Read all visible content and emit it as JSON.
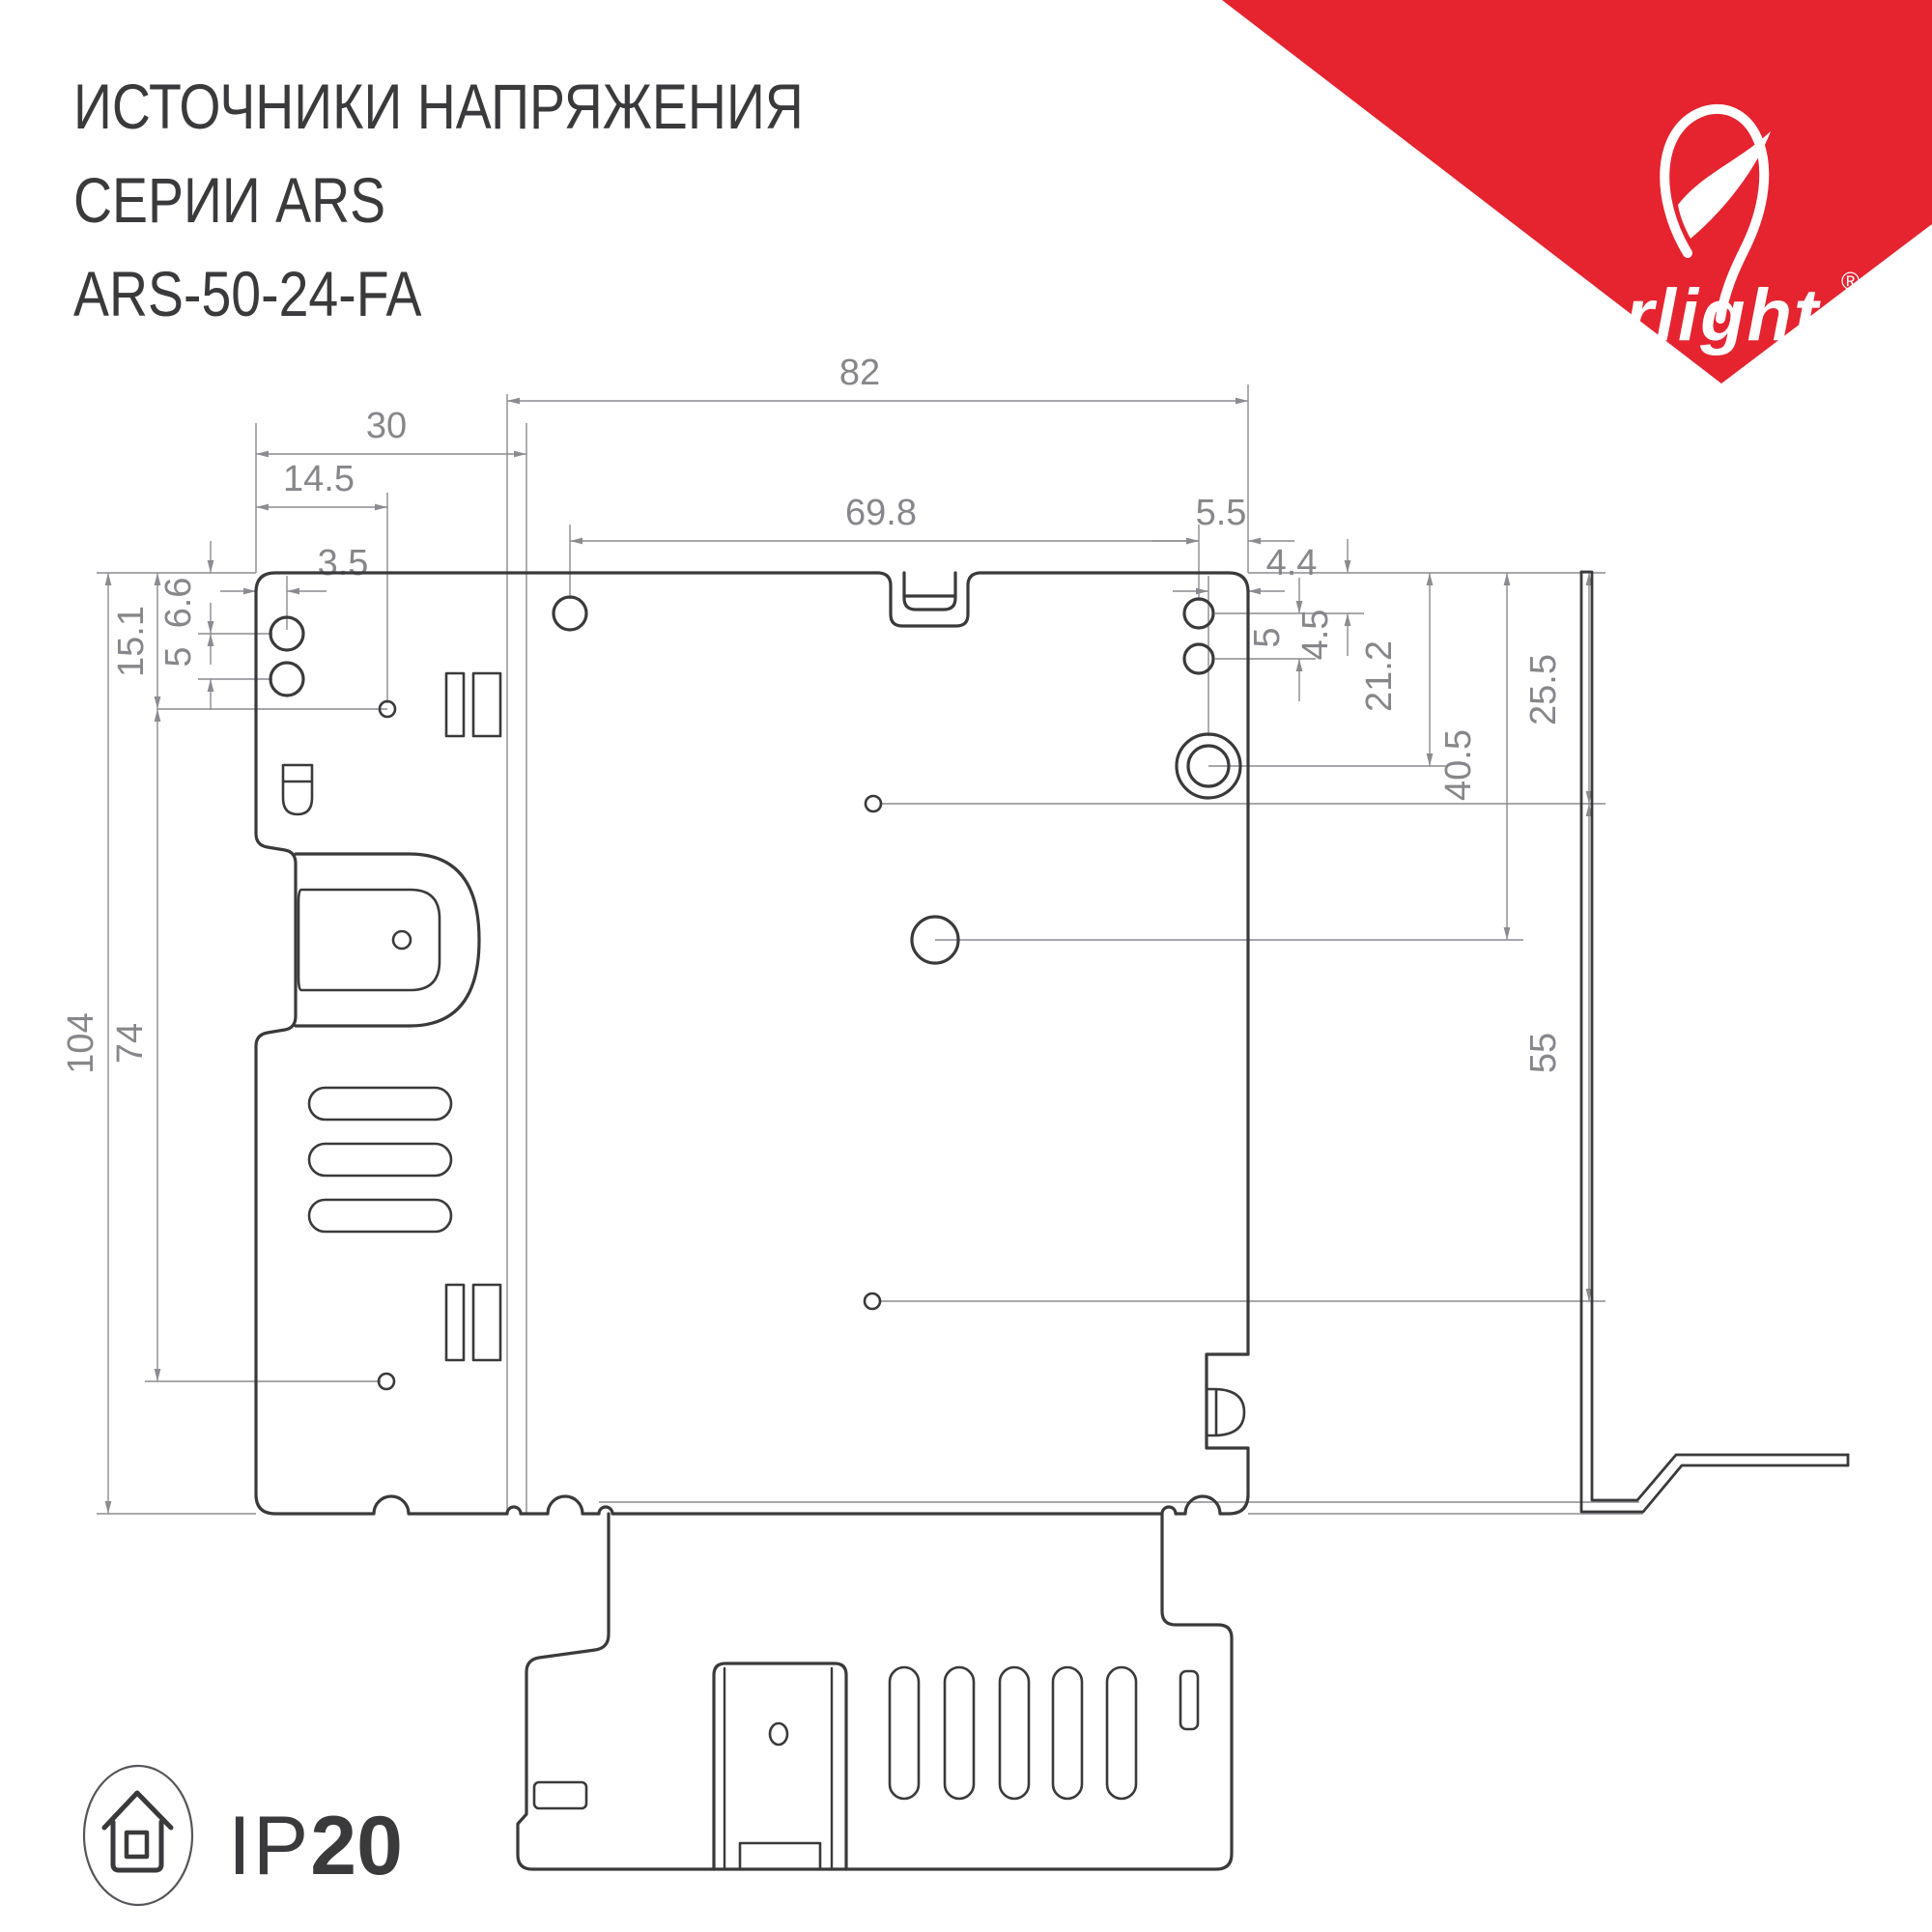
{
  "header": {
    "title_line1": "ИСТОЧНИКИ НАПРЯЖЕНИЯ",
    "title_line2": "СЕРИИ ARS",
    "title_line3": "ARS-50-24-FA"
  },
  "brand": {
    "logo_text": "arlight",
    "registered_mark": "®",
    "accent_color": "#e52430"
  },
  "drawing": {
    "line_colors": {
      "thick": "#3a3a3c",
      "thin": "#8b8b90"
    },
    "dimensions_mm": {
      "d82": "82",
      "d30": "30",
      "d14_5": "14.5",
      "d3_5": "3.5",
      "d69_8": "69.8",
      "d5_5": "5.5",
      "d4_4": "4.4",
      "d15_1": "15.1",
      "d6_6": "6.6",
      "d5_left": "5",
      "d104": "104",
      "d74": "74",
      "d4_5": "4.5",
      "d5_right": "5",
      "d21_2": "21.2",
      "d40_5": "40.5",
      "d25_5": "25.5",
      "d55": "55"
    }
  },
  "footer": {
    "ip_icon": "house-in-circle-icon",
    "ip_rating_prefix": "IP",
    "ip_rating_value": "20"
  }
}
